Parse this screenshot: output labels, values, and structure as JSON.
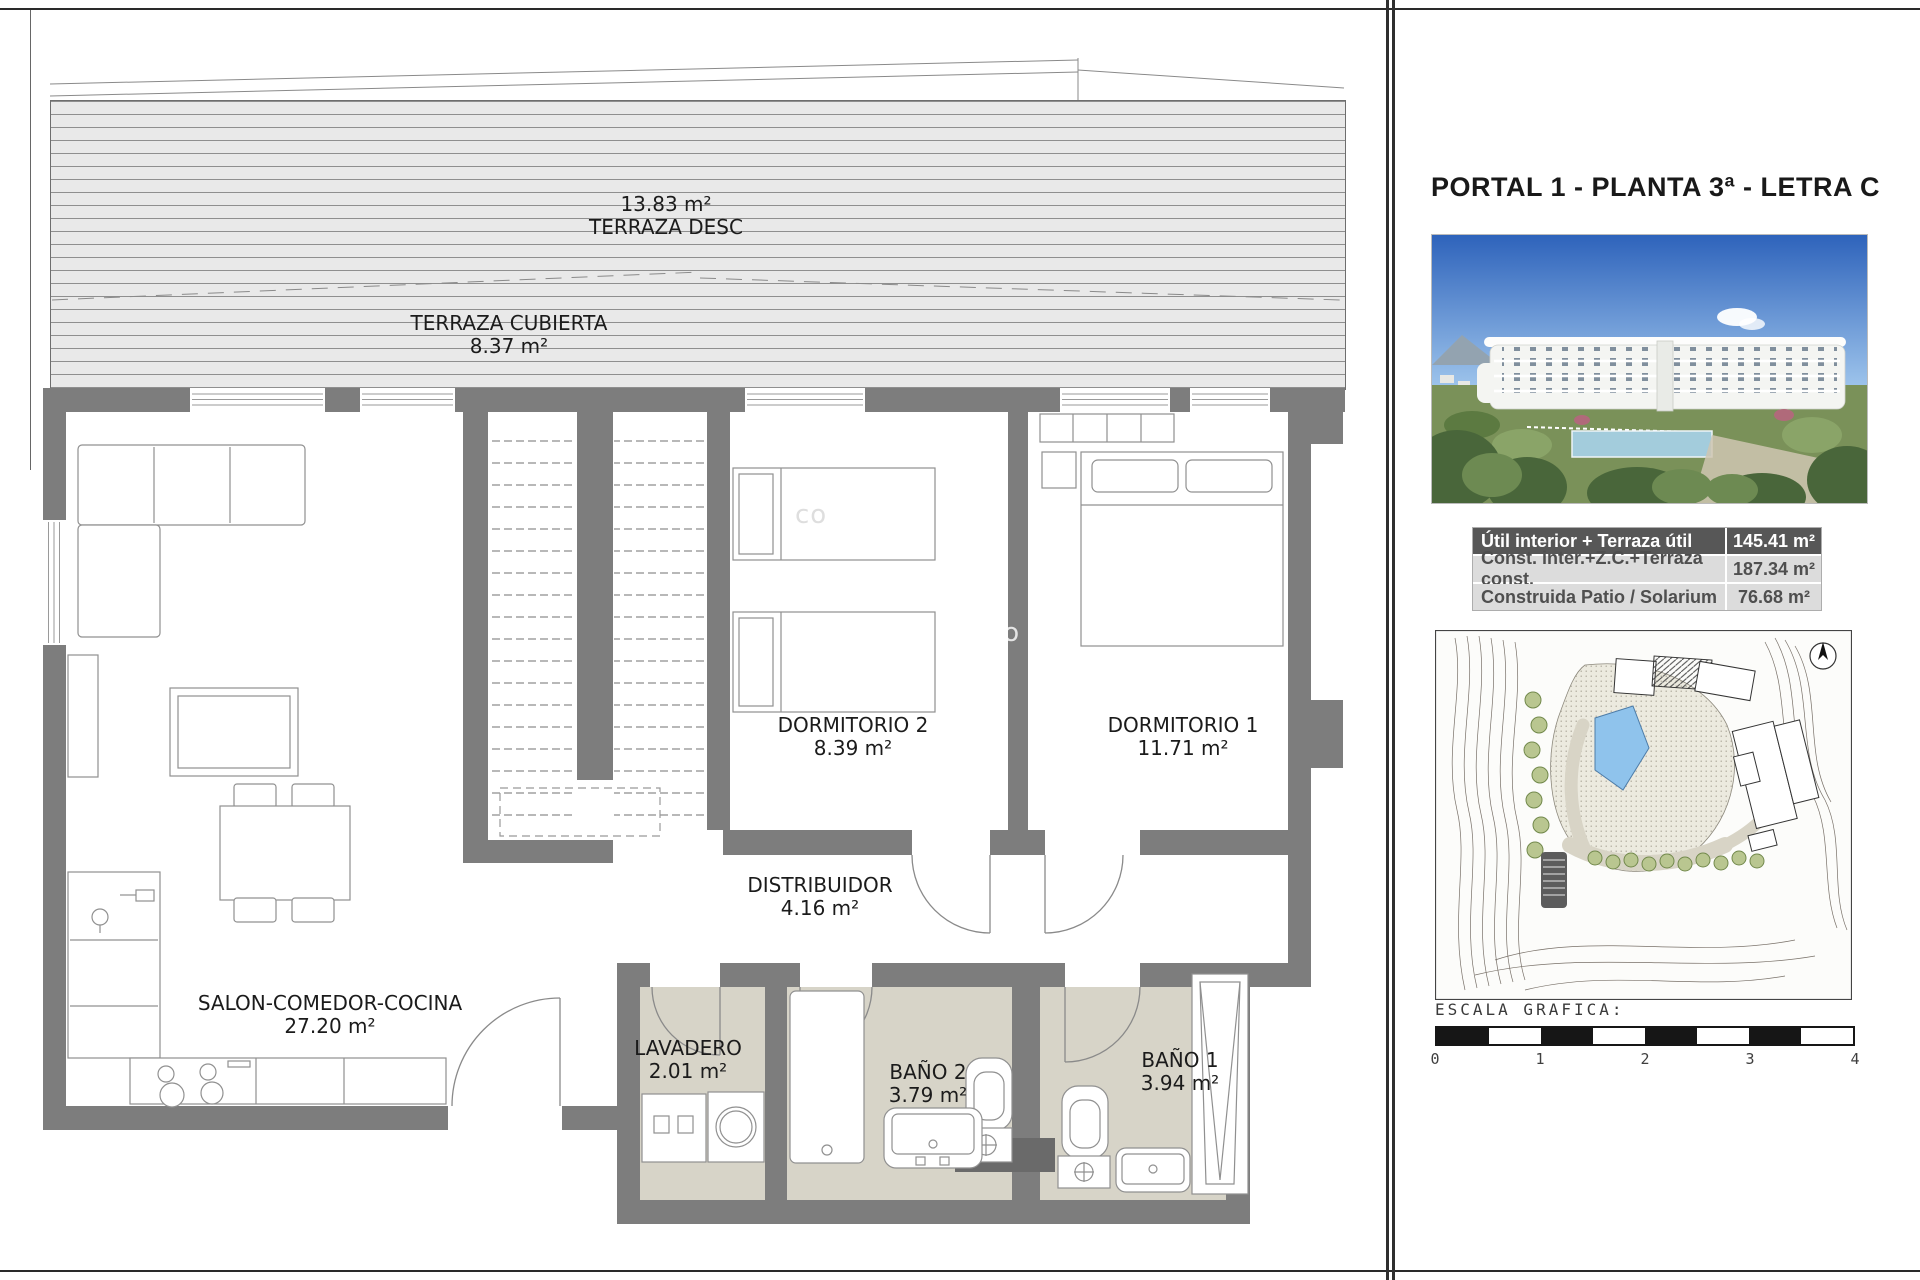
{
  "floor_plan": {
    "terrace_desc": {
      "area": "13.83 m²",
      "name": "TERRAZA DESC"
    },
    "terrace_cubierta": {
      "name": "TERRAZA CUBIERTA",
      "area": "8.37 m²"
    },
    "rooms": [
      {
        "name": "DORMITORIO 2",
        "area": "8.39 m²"
      },
      {
        "name": "DORMITORIO 1",
        "area": "11.71 m²"
      },
      {
        "name": "DISTRIBUIDOR",
        "area": "4.16 m²"
      },
      {
        "name": "SALON-COMEDOR-COCINA",
        "area": "27.20 m²"
      },
      {
        "name": "LAVADERO",
        "area": "2.01 m²"
      },
      {
        "name": "BAÑO 2",
        "area": "3.79 m²"
      },
      {
        "name": "BAÑO 1",
        "area": "3.94 m²"
      }
    ],
    "watermark": {
      "fragment_1": "co",
      "fragment_2": "to"
    }
  },
  "side_panel": {
    "title": "PORTAL 1 - PLANTA 3ª - LETRA C",
    "areas_table": {
      "rows": [
        {
          "label": "Útil interior + Terraza útil",
          "value": "145.41 m²"
        },
        {
          "label": "Const. inter.+Z.C.+Terraza const.",
          "value": "187.34 m²"
        },
        {
          "label": "Construida Patio / Solarium",
          "value": "76.68 m²"
        }
      ]
    },
    "scale": {
      "label": "ESCALA GRAFICA:",
      "ticks": [
        "0",
        "1",
        "2",
        "3",
        "4"
      ]
    }
  },
  "colors": {
    "wall": "#7d7d7d",
    "wet_floor": "#d7d4c8",
    "terrace_bg": "#e9e9e9",
    "table_header_bg": "#575757",
    "table_row_bg": "#dcdcdc"
  }
}
